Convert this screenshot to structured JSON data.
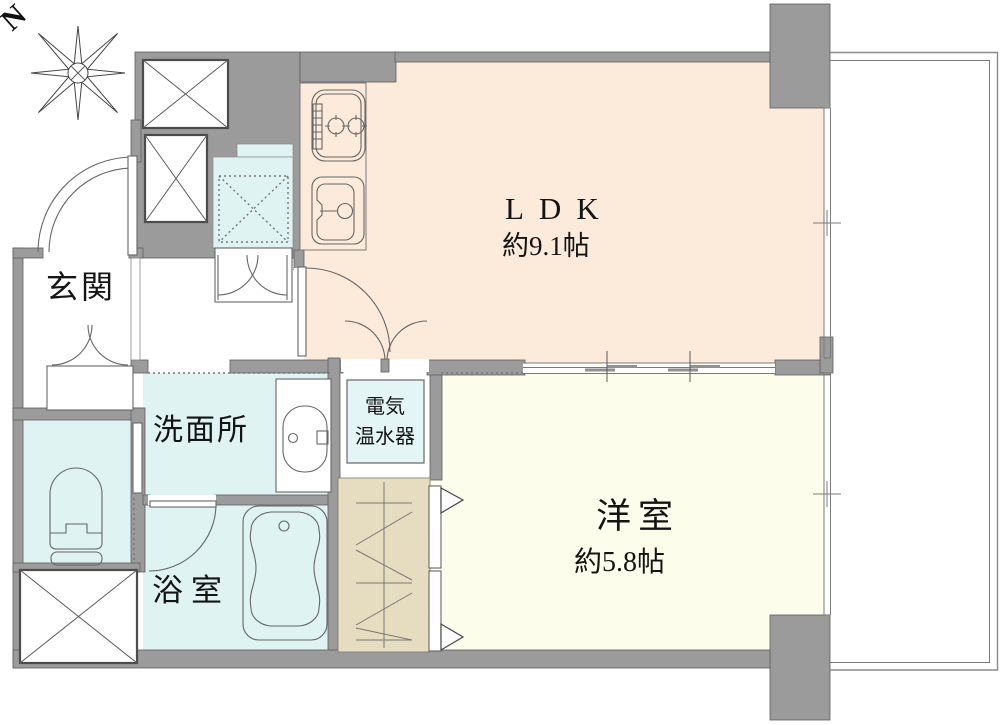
{
  "plan": {
    "compass_north": "N",
    "rooms": {
      "entrance": {
        "label": "玄関"
      },
      "ldk": {
        "label": "LDK",
        "size": "約9.1帖"
      },
      "western_room": {
        "label": "洋室",
        "size": "約5.8帖"
      },
      "washroom": {
        "label": "洗面所"
      },
      "bathroom": {
        "label": "浴室"
      },
      "water_heater": {
        "line1": "電気",
        "line2": "温水器"
      }
    },
    "colors": {
      "wall": "#9b9b9b",
      "wall-outline": "#5e5e5e",
      "ldk-bg": "#fceada",
      "western-bg": "#fcfdeb",
      "wet-bg": "#dff3f2",
      "heater-bg": "#e4f5f6",
      "closet-bg": "#e6dcc0",
      "line": "#555555",
      "text": "#141414"
    }
  }
}
